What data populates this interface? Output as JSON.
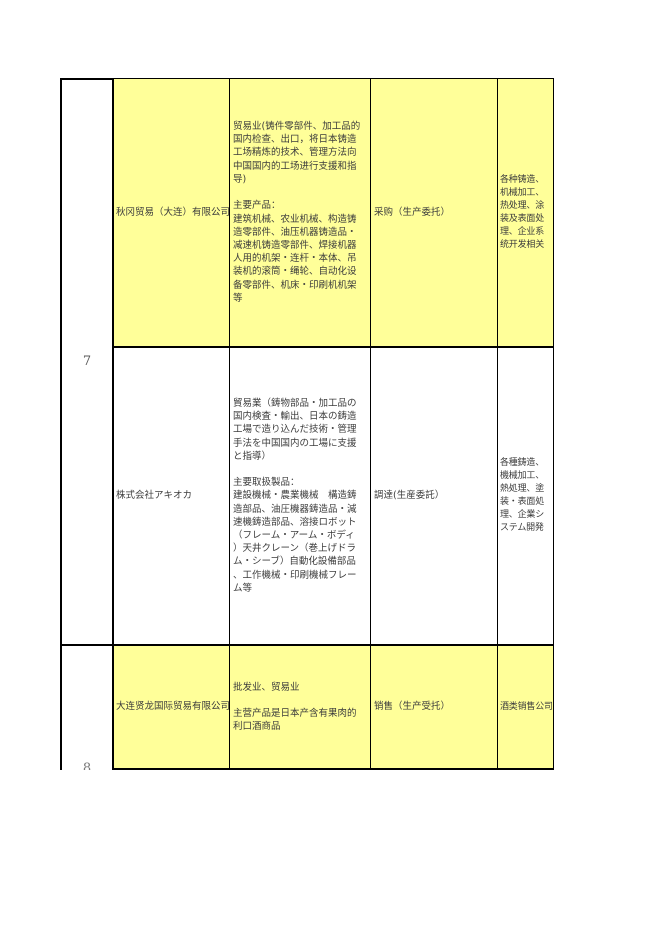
{
  "colors": {
    "row_highlight": "#ffff99",
    "grid_line": "#000000",
    "cell_text": "#3c3c3c",
    "row_number_text": "#595959"
  },
  "row_numbers": {
    "current": "7",
    "next_partial": "8"
  },
  "rows": [
    {
      "highlighted": true,
      "company": "秋冈贸易（大连）有限公司",
      "business": "贸易业(铸件零部件、加工品的\n国内检查、出口，将日本铸造\n工场精炼的技术、管理方法向\n中国国内的工场进行支援和指\n导)\n\n主要产品：\n建筑机械、农业机械、构造铸\n造零部件、油压机器铸造品・\n减速机铸造零部件、焊接机器\n人用的机架・连杆・本体、吊\n装机的滚筒・绳轮、自动化设\n备零部件、机床・印刷机机架\n等",
      "cooperation": "采购（生产委托）",
      "partner": "各种铸造、\n机械加工、\n热处理、涂\n装及表面处\n理、企业系\n统开发相关"
    },
    {
      "highlighted": false,
      "company": "株式会社アキオカ",
      "business": "貿易業（鋳物部品・加工品の\n国内検査・輸出、日本の鋳造\n工場で造り込んだ技術・管理\n手法を中国国内の工場に支援\nと指導）\n\n主要取扱製品：\n建設機械・農業機械　構造鋳\n造部品、油圧機器鋳造品・減\n速機鋳造部品、溶接ロボット\n（フレーム・アーム・ボディ\n）天井クレーン（巻上げドラ\nム・シーブ）自動化設備部品\n、工作機械・印刷機械フレー\nム等",
      "cooperation": "調達(生産委託）",
      "partner": "各種鋳造、\n機械加工、\n熱処理、塗\n装・表面処\n理、企業シ\nステム開発"
    },
    {
      "highlighted": true,
      "company": "大连贤龙国际贸易有限公司",
      "business": "批发业、贸易业\n\n主营产品是日本产含有果肉的\n利口酒商品",
      "cooperation": "销售（生产受托）",
      "partner": "酒类销售公司"
    }
  ]
}
